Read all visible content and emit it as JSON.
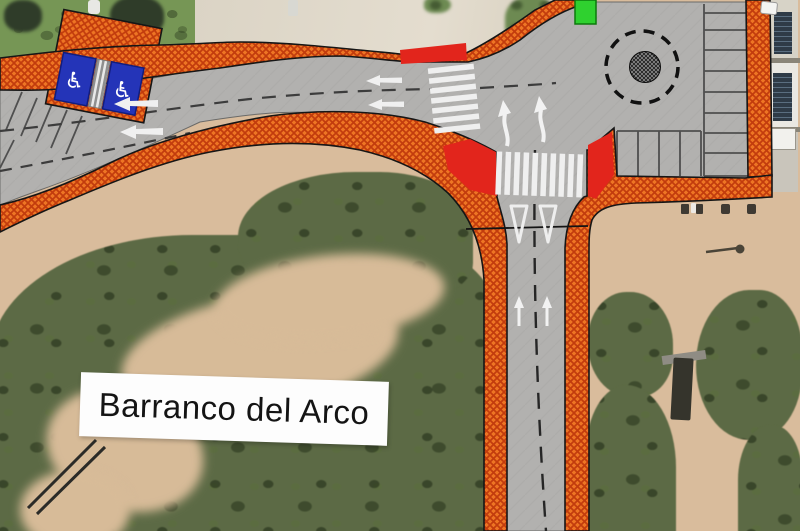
{
  "area_label": {
    "text": "Barranco del Arco"
  },
  "icons": {
    "wheelchair": "♿"
  },
  "palette": {
    "construction_hatch_orange": "#ee7524",
    "hatch_crosshatch_red": "#c23c0d",
    "closure_red": "#e2251c",
    "road_gray": "#b2b1af",
    "accessible_parking_blue": "#2434b8",
    "marker_green": "#2fd12f",
    "road_marking_white": "#f2f2f2",
    "aerial_sand": "#d9bc9c",
    "aerial_grass": "#769655",
    "aerial_scrub": "#5c6a45",
    "aerial_concrete": "#dbd4c5"
  },
  "features": {
    "accessible_parking_stalls": 2,
    "crosswalks": 2,
    "roundabouts": 1,
    "parking_stalls_right_column": 8,
    "parking_stalls_bottom_row": 4,
    "diagonal_stalls_left_edge": 6,
    "lane_arrows_left": 4,
    "lane_arrows_up": 2,
    "turn_arrows": 2,
    "yield_markings": 2
  }
}
